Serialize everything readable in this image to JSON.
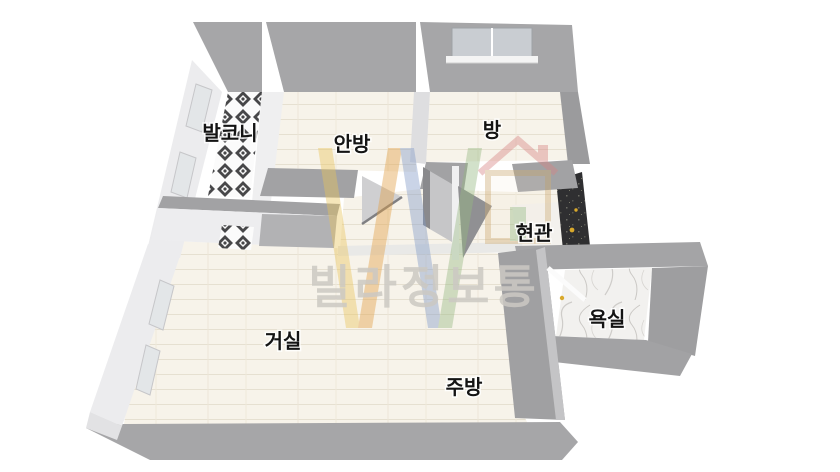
{
  "scene": {
    "background": "#ffffff",
    "view": "3d-tilted-top-down-floor-plan"
  },
  "watermark": {
    "text": "빌라정보통",
    "color": "#ccc9c3",
    "logo": "villa-info-tong-w-house-logo"
  },
  "rooms": [
    {
      "id": "balcony",
      "label": "발코니",
      "floor": "black-white-diamond-tile"
    },
    {
      "id": "master-bedroom",
      "label": "안방",
      "floor": "cream-wood-plank"
    },
    {
      "id": "room",
      "label": "방",
      "floor": "cream-wood-plank",
      "features": [
        "window-on-top-wall"
      ]
    },
    {
      "id": "entrance",
      "label": "현관",
      "floor": "white-tile",
      "features": [
        "dark-entry-pad"
      ]
    },
    {
      "id": "bathroom",
      "label": "욕실",
      "floor": "white-marble",
      "features": [
        "open-door",
        "yellow-handle"
      ]
    },
    {
      "id": "living-room",
      "label": "거실",
      "floor": "cream-wood-plank"
    },
    {
      "id": "kitchen",
      "label": "주방",
      "floor": "cream-wood-plank"
    }
  ],
  "palette": {
    "wall_gray": "#a6a6a8",
    "wall_gray_dark": "#9b9b9d",
    "wall_white": "#ececee",
    "floor_cream": "#f7f3ea",
    "floor_plank_line": "#e6e0d1",
    "balcony_tile_dark": "#474749",
    "marble_vein": "#c0beba",
    "entry_pad_dark": "#2f2f31",
    "accent_yellow": "#d9a92c",
    "window_pane": "#c9cdd2",
    "label_black": "#141414",
    "watermark_gray": "#ccc9c3",
    "logo_red": "#d78484"
  }
}
